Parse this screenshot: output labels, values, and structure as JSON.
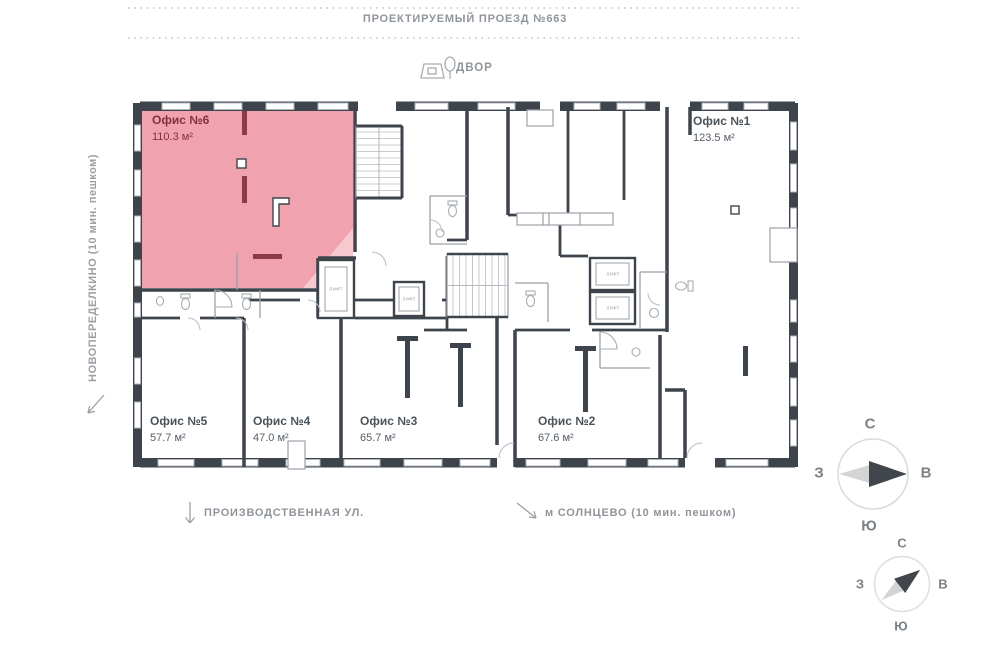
{
  "surroundings": {
    "top_street": "ПРОЕКТИРУЕМЫЙ ПРОЕЗД №663",
    "yard": "ДВОР",
    "left_street": "НОВОПЕРЕДЕЛКИНО (10 мин. пешком)",
    "bottom_street": "ПРОИЗВОДСТВЕННАЯ УЛ.",
    "metro": "м СОЛНЦЕВО (10 мин. пешком)"
  },
  "offices": [
    {
      "name": "Офис №6",
      "area": "110.3 м²",
      "highlighted": true
    },
    {
      "name": "Офис №1",
      "area": "123.5 м²",
      "highlighted": false
    },
    {
      "name": "Офис №5",
      "area": "57.7 м²",
      "highlighted": false
    },
    {
      "name": "Офис №4",
      "area": "47.0 м²",
      "highlighted": false
    },
    {
      "name": "Офис №3",
      "area": "65.7 м²",
      "highlighted": false
    },
    {
      "name": "Офис №2",
      "area": "67.6 м²",
      "highlighted": false
    }
  ],
  "plan": {
    "lift_label": "ЛИФТ"
  },
  "compass": {
    "n": "С",
    "s": "Ю",
    "w": "З",
    "e": "В"
  },
  "colors": {
    "highlight_fill": "#f0a2ae",
    "highlight_text": "#84303f",
    "wall": "#3e444b",
    "inner_wall_accent": "#8d3a48",
    "muted_text": "#8f959b"
  }
}
